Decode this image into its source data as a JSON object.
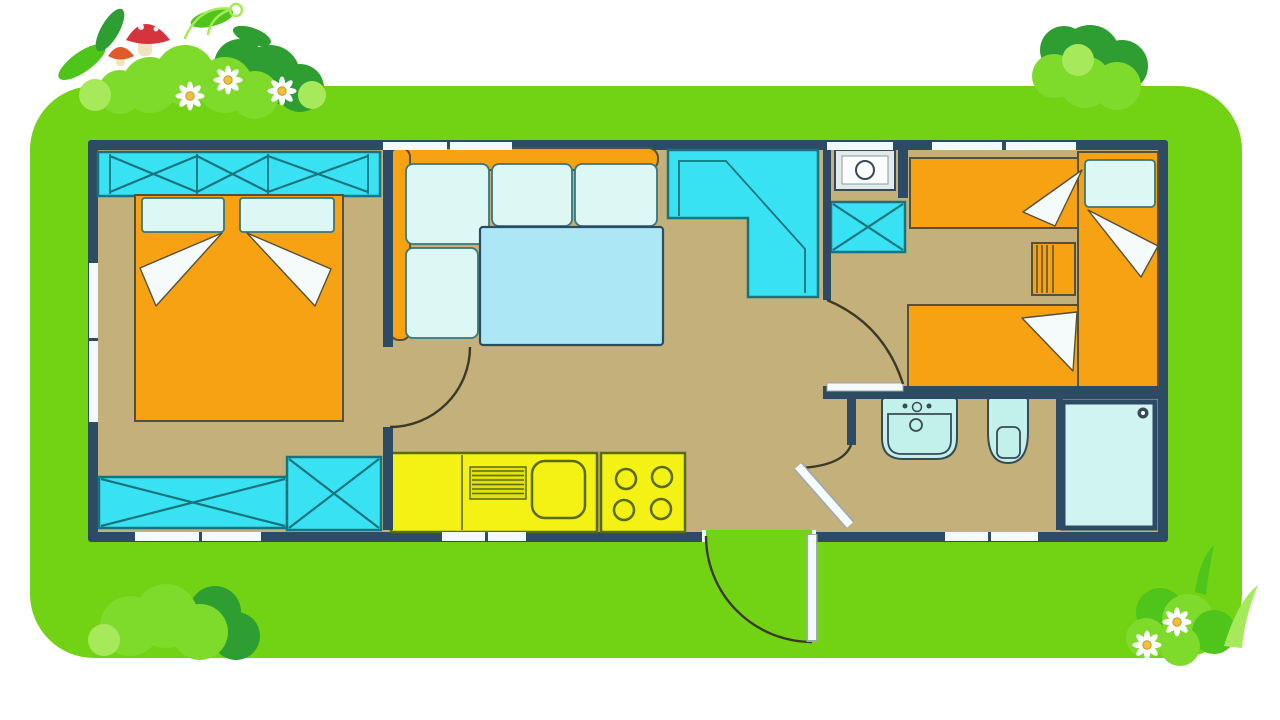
{
  "scene": {
    "description": "Cartoon illustrated floor plan of a mobile home on a bright green lawn decorated with bushes, daisies, grass and mushrooms",
    "visible_text": []
  },
  "palette": {
    "page-bg": "#FFFFFF",
    "lawn": "#72D214",
    "bush-dark": "#2E9E33",
    "bush-mid": "#4FC41A",
    "bush-light": "#7EDA2B",
    "bush-pale": "#A6E95A",
    "mushroom-red": "#D5343C",
    "mushroom-orange": "#E05A2B",
    "mushroom-stem": "#F2E3C0",
    "flower-petal": "#FFFFFF",
    "flower-center": "#EFBF3F",
    "wall": "#2E4B66",
    "floor": "#C3B07A",
    "window": "#F2FAFC",
    "cyan": "#39E2F2",
    "cyan-stroke": "#17747F",
    "pale": "#DCF7F4",
    "pale-stroke": "#37777E",
    "table": "#ABE7F4",
    "orange": "#F7A213",
    "orange-stroke": "#55503A",
    "yellow": "#F4F115",
    "yellow-stroke": "#5A6A10",
    "fixture": "#C2F1EB",
    "fixture-stroke": "#3A4A55",
    "shower": "#CFF4F2",
    "linen": "#F5FBFA",
    "door-arc": "#3B3A26",
    "leaf-frame": "#9AA8B0",
    "heater-body": "#E3EAEA",
    "heater-inner": "#FBFDFD",
    "drainer": "#E3E00F"
  },
  "plan": {
    "elements": [
      "exterior-walls",
      "windows",
      "wardrobe-crossed",
      "double-bed",
      "pillows",
      "under-window-storage",
      "storage-box",
      "corner-sofa",
      "sofa-cushions",
      "dining-table",
      "corner-worktop",
      "kitchen-counter",
      "drainer",
      "kitchen-sink",
      "stove-four-burners",
      "water-heater",
      "crossed-cabinet",
      "single-bed-top",
      "single-bed-bottom",
      "single-bed-right",
      "nightstand",
      "bathroom-sink",
      "toilet",
      "shower-tray",
      "interior-doors",
      "entrance-door"
    ]
  }
}
